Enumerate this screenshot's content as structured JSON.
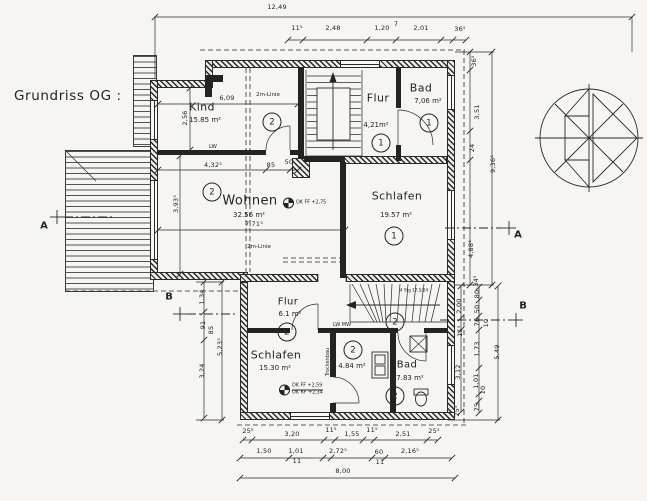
{
  "title": "Grundriss OG :",
  "colors": {
    "ink": "#23231f",
    "paper": "#f6f5f1"
  },
  "icons": {
    "north": "north-arrow-icon",
    "level_marker": "level-marker-icon"
  },
  "rooms": [
    {
      "name": "Kind",
      "area": "15.85 m²",
      "num": "2",
      "nx": 202,
      "ny": 107,
      "ns": 11,
      "ax": 205,
      "ay": 120,
      "cx": 272,
      "cy": 122
    },
    {
      "name": "Flur",
      "area": "4,21m²",
      "num": "1",
      "nx": 378,
      "ny": 98,
      "ns": 11,
      "ax": 376,
      "ay": 125,
      "cx": 381,
      "cy": 143
    },
    {
      "name": "Bad",
      "area": "7,06 m²",
      "num": "1",
      "nx": 421,
      "ny": 88,
      "ns": 11,
      "ax": 428,
      "ay": 101,
      "cx": 429,
      "cy": 123
    },
    {
      "name": "Wohnen",
      "area": "32.56 m²",
      "num": "2",
      "nx": 250,
      "ny": 201,
      "ns": 13,
      "ax": 249,
      "ay": 215,
      "cx": 212,
      "cy": 192
    },
    {
      "name": "Schlafen",
      "area": "19.57 m²",
      "num": "1",
      "nx": 397,
      "ny": 196,
      "ns": 11,
      "ax": 396,
      "ay": 215,
      "cx": 394,
      "cy": 236
    },
    {
      "name": "Flur",
      "area": "6.1 m²",
      "num": "2",
      "nx": 288,
      "ny": 302,
      "ns": 10,
      "ax": 290,
      "ay": 314,
      "cx": 395,
      "cy": 322
    },
    {
      "name": "Schlafen",
      "area": "15.30 m²",
      "num": "2",
      "nx": 276,
      "ny": 355,
      "ns": 11,
      "ax": 275,
      "ay": 368,
      "cx": 287,
      "cy": 332
    },
    {
      "name": "",
      "area": "4.84 m²",
      "num": "2",
      "nx": 0,
      "ny": 0,
      "ns": 10,
      "ax": 352,
      "ay": 366,
      "cx": 353,
      "cy": 350
    },
    {
      "name": "Bad",
      "area": "7.83 m²",
      "num": "2",
      "nx": 407,
      "ny": 365,
      "ns": 10,
      "ax": 410,
      "ay": 378,
      "cx": 395,
      "cy": 396
    }
  ],
  "dims": [
    {
      "t": "12,49",
      "x": 277,
      "y": 7
    },
    {
      "t": "11⁵",
      "x": 297,
      "y": 28
    },
    {
      "t": "2,48",
      "x": 333,
      "y": 28
    },
    {
      "t": "1,20",
      "x": 382,
      "y": 28
    },
    {
      "t": "7",
      "x": 396,
      "y": 24
    },
    {
      "t": "2,01",
      "x": 421,
      "y": 28
    },
    {
      "t": "36⁵",
      "x": 460,
      "y": 29
    },
    {
      "t": "36⁵",
      "x": 474,
      "y": 61,
      "r": -90
    },
    {
      "t": "3,51",
      "x": 477,
      "y": 112,
      "r": -90
    },
    {
      "t": "24",
      "x": 472,
      "y": 148,
      "r": -90
    },
    {
      "t": "4,88⁵",
      "x": 471,
      "y": 249,
      "r": -90
    },
    {
      "t": "9,36⁵",
      "x": 493,
      "y": 164,
      "r": -90
    },
    {
      "t": "34⁵",
      "x": 476,
      "y": 281,
      "r": -90
    },
    {
      "t": "80",
      "x": 477,
      "y": 294,
      "r": -90
    },
    {
      "t": "50",
      "x": 477,
      "y": 309,
      "r": -90
    },
    {
      "t": "76",
      "x": 477,
      "y": 322,
      "r": -90
    },
    {
      "t": "10",
      "x": 486,
      "y": 323,
      "r": -90
    },
    {
      "t": "1,73",
      "x": 477,
      "y": 349,
      "r": -90
    },
    {
      "t": "1,01",
      "x": 476,
      "y": 381,
      "r": -90
    },
    {
      "t": "10",
      "x": 483,
      "y": 390,
      "r": -90
    },
    {
      "t": "75",
      "x": 477,
      "y": 407,
      "r": -90
    },
    {
      "t": "2,00",
      "x": 459,
      "y": 306,
      "r": -90
    },
    {
      "t": "11⁵",
      "x": 460,
      "y": 331,
      "r": -90
    },
    {
      "t": "3,12",
      "x": 458,
      "y": 372,
      "r": -90
    },
    {
      "t": "25⁵",
      "x": 457,
      "y": 411,
      "r": -90
    },
    {
      "t": "5,49",
      "x": 497,
      "y": 352,
      "r": -90
    },
    {
      "t": "1,34",
      "x": 202,
      "y": 297,
      "r": -90
    },
    {
      "t": "91",
      "x": 203,
      "y": 325,
      "r": -90
    },
    {
      "t": "85",
      "x": 211,
      "y": 330,
      "r": -90
    },
    {
      "t": "3,24",
      "x": 202,
      "y": 371,
      "r": -90
    },
    {
      "t": "5,23⁵",
      "x": 220,
      "y": 347,
      "r": -90
    },
    {
      "t": "25⁵",
      "x": 248,
      "y": 431
    },
    {
      "t": "3,20",
      "x": 292,
      "y": 434
    },
    {
      "t": "11⁵",
      "x": 331,
      "y": 430
    },
    {
      "t": "1,55",
      "x": 352,
      "y": 434
    },
    {
      "t": "11⁵",
      "x": 372,
      "y": 430
    },
    {
      "t": "2,51",
      "x": 403,
      "y": 434
    },
    {
      "t": "25⁵",
      "x": 434,
      "y": 431
    },
    {
      "t": "1,50",
      "x": 264,
      "y": 451
    },
    {
      "t": "1,01",
      "x": 296,
      "y": 451
    },
    {
      "t": "11",
      "x": 297,
      "y": 461
    },
    {
      "t": "2,72⁵",
      "x": 338,
      "y": 451
    },
    {
      "t": "60",
      "x": 379,
      "y": 452
    },
    {
      "t": "11",
      "x": 380,
      "y": 462
    },
    {
      "t": "2,16⁵",
      "x": 410,
      "y": 451
    },
    {
      "t": "8,00",
      "x": 343,
      "y": 471
    },
    {
      "t": "6,09",
      "x": 227,
      "y": 98
    },
    {
      "t": "2,56",
      "x": 185,
      "y": 118,
      "r": -90
    },
    {
      "t": "4,32⁵",
      "x": 213,
      "y": 165
    },
    {
      "t": "85",
      "x": 271,
      "y": 165
    },
    {
      "t": "50",
      "x": 289,
      "y": 162
    },
    {
      "t": "3,93⁵",
      "x": 176,
      "y": 204,
      "r": -90
    },
    {
      "t": "7,71⁵",
      "x": 254,
      "y": 224
    }
  ],
  "labels": [
    {
      "t": "2m-Linie",
      "x": 268,
      "y": 95
    },
    {
      "t": "2m-Linie",
      "x": 259,
      "y": 247
    },
    {
      "t": "LW",
      "x": 213,
      "y": 147
    },
    {
      "t": "LW MW",
      "x": 342,
      "y": 325,
      "s": 5
    },
    {
      "t": "Trockenbau",
      "x": 328,
      "y": 362,
      "s": 5,
      "r": -90
    },
    {
      "t": "4 Stg 17,5/24",
      "x": 414,
      "y": 290,
      "s": 4.2
    }
  ],
  "level_marks": [
    {
      "x": 283,
      "y": 203,
      "lines": [
        "OK FF +2,75"
      ]
    },
    {
      "x": 279,
      "y": 390,
      "lines": [
        "OK FF +2,59",
        "OK RF +2,34"
      ]
    }
  ],
  "sections": [
    {
      "t": "A",
      "x": 44,
      "y": 226
    },
    {
      "t": "A",
      "x": 518,
      "y": 235
    },
    {
      "t": "B",
      "x": 169,
      "y": 297
    },
    {
      "t": "B",
      "x": 523,
      "y": 306
    }
  ]
}
